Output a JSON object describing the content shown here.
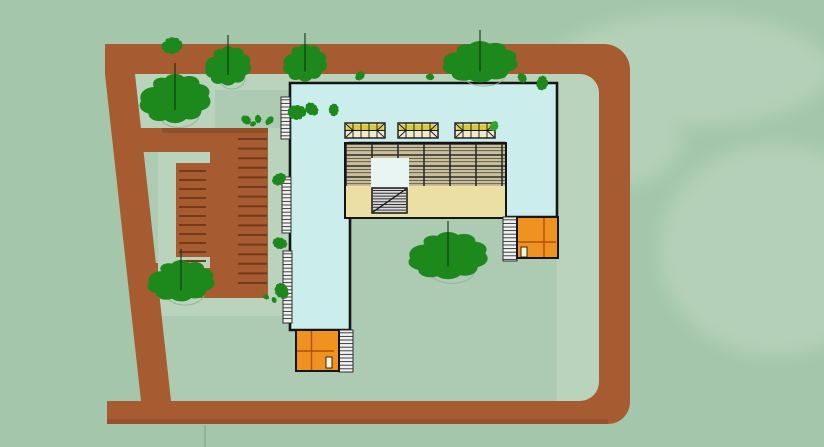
{
  "scene_title": "architectural-site-plan-top-view",
  "colors": {
    "background": "#A4C7AC",
    "background_light": "#C4DAC4",
    "ground_inner": "#ADCBB3",
    "walkway": "#B9D3BD",
    "road": "#A65B30",
    "road_shadow": "#8C4A26",
    "parking_stripe": "#77391B",
    "roof_cyan": "#CBEDEB",
    "outline": "#151515",
    "grid_bg": "#C9C09B",
    "grid_thin": "#55514A",
    "grid_thick": "#2B2B27",
    "beige": "#EBDFA4",
    "skylight_bg": "#F0EACD",
    "skylight_yellow": "#D6C52F",
    "hatch_bg": "#F1F1F1",
    "hatch_line": "#2E2E2E",
    "stair_bg": "#D9D9D9",
    "stair_line": "#333333",
    "orange": "#F0921F",
    "orange_line": "#AE5208",
    "door": "#F9F4D9",
    "tree_dark": "#1D891D",
    "tree_mid": "#2FA42F",
    "trunk": "#123312",
    "canopy_outline": "#8FAF95",
    "pavement_line": "#85A58B"
  },
  "scene": {
    "trees": [
      {
        "cx": 175,
        "cy": 100,
        "rx": 34,
        "ry": 25,
        "color": "tree_dark",
        "trunk": true,
        "outline": true
      },
      {
        "cx": 228,
        "cy": 67,
        "rx": 22,
        "ry": 20,
        "color": "tree_dark",
        "trunk": true,
        "outline": true
      },
      {
        "cx": 305,
        "cy": 64,
        "rx": 21,
        "ry": 19,
        "color": "tree_dark",
        "trunk": true,
        "outline": false
      },
      {
        "cx": 480,
        "cy": 63,
        "rx": 36,
        "ry": 21,
        "color": "tree_dark",
        "trunk": true,
        "outline": true
      },
      {
        "cx": 181,
        "cy": 282,
        "rx": 32,
        "ry": 21,
        "color": "tree_dark",
        "trunk": true,
        "outline": true
      },
      {
        "cx": 448,
        "cy": 257,
        "rx": 38,
        "ry": 24,
        "color": "tree_dark",
        "trunk": true,
        "outline": true
      }
    ],
    "bushes": [
      {
        "cx": 172,
        "cy": 46,
        "r": 10,
        "color": "tree_dark"
      },
      {
        "cx": 246,
        "cy": 120,
        "r": 5,
        "color": "tree_dark"
      },
      {
        "cx": 258,
        "cy": 119,
        "r": 4,
        "color": "tree_dark"
      },
      {
        "cx": 270,
        "cy": 120,
        "r": 4,
        "color": "tree_dark"
      },
      {
        "cx": 297,
        "cy": 112,
        "r": 9,
        "color": "tree_dark"
      },
      {
        "cx": 312,
        "cy": 109,
        "r": 7,
        "color": "tree_dark"
      },
      {
        "cx": 334,
        "cy": 110,
        "r": 6,
        "color": "tree_dark"
      },
      {
        "cx": 360,
        "cy": 76,
        "r": 5,
        "color": "tree_dark"
      },
      {
        "cx": 430,
        "cy": 77,
        "r": 4,
        "color": "tree_dark"
      },
      {
        "cx": 522,
        "cy": 78,
        "r": 5,
        "color": "tree_dark"
      },
      {
        "cx": 542,
        "cy": 83,
        "r": 7,
        "color": "tree_dark"
      },
      {
        "cx": 279,
        "cy": 179,
        "r": 7,
        "color": "tree_dark"
      },
      {
        "cx": 280,
        "cy": 243,
        "r": 7,
        "color": "tree_dark"
      },
      {
        "cx": 282,
        "cy": 291,
        "r": 8,
        "color": "tree_dark"
      },
      {
        "cx": 268,
        "cy": 122,
        "r": 3,
        "color": "tree_dark"
      },
      {
        "cx": 253,
        "cy": 124,
        "r": 3,
        "color": "tree_dark"
      },
      {
        "cx": 266,
        "cy": 297,
        "r": 3,
        "color": "tree_dark"
      },
      {
        "cx": 274,
        "cy": 300,
        "r": 3,
        "color": "tree_dark"
      },
      {
        "cx": 494,
        "cy": 126,
        "r": 5,
        "color": "tree_mid"
      }
    ],
    "parking_stripes": [
      {
        "x1": 238,
        "x2": 267,
        "y0": 139,
        "step": 9.6,
        "count": 16
      },
      {
        "x1": 179,
        "x2": 206,
        "y0": 171,
        "step": 9.0,
        "count": 11
      }
    ],
    "hatch_strips": [
      {
        "x": 281,
        "y": 97,
        "w": 9,
        "h": 42
      },
      {
        "x": 282,
        "y": 177,
        "w": 9,
        "h": 56
      },
      {
        "x": 283,
        "y": 251,
        "w": 9,
        "h": 72
      },
      {
        "x": 339,
        "y": 330,
        "w": 14,
        "h": 42
      },
      {
        "x": 503,
        "y": 217,
        "w": 14,
        "h": 44
      }
    ],
    "skylights": [
      {
        "x": 345,
        "y": 123
      },
      {
        "x": 398,
        "y": 123
      },
      {
        "x": 455,
        "y": 123
      }
    ]
  }
}
